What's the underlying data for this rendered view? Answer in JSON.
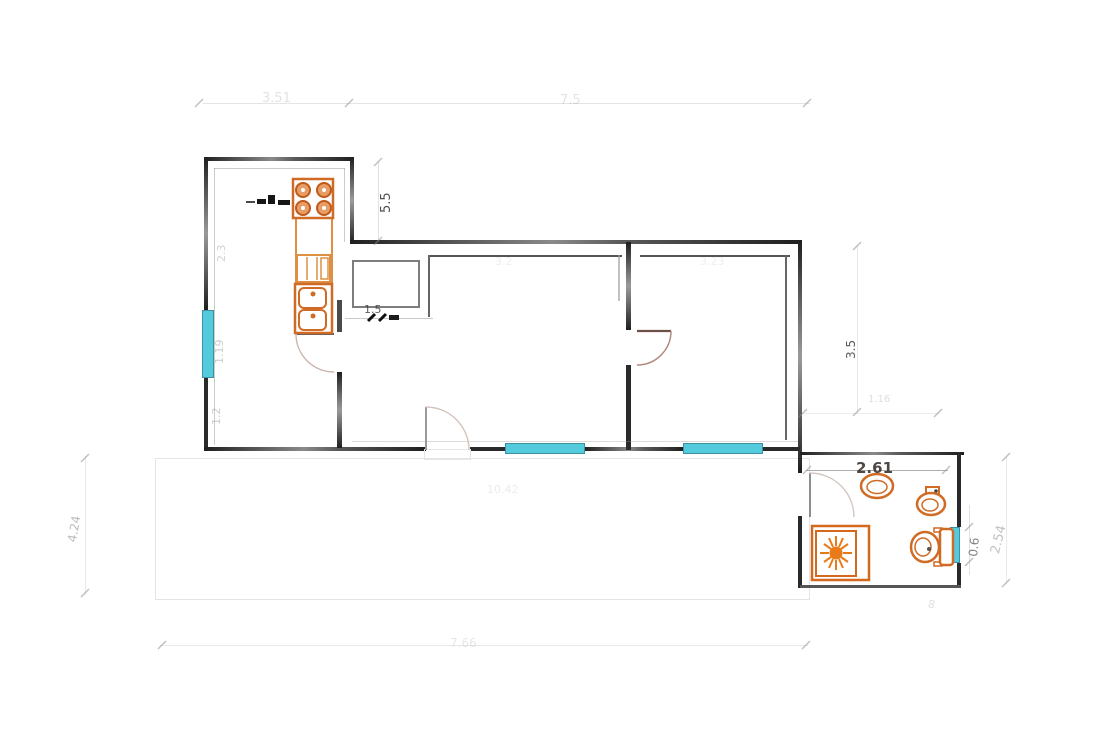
{
  "document": {
    "type": "architectural-floor-plan",
    "description": "Faded scan of an apartment floor plan: kitchen with stove and sink on the left, hallway with closet, two rooms with windows, bathroom with shower, washbasin, bidet and toilet on the lower right, terrace outline below"
  },
  "colors": {
    "background": "#ffffff",
    "wall": "#2a2a2a",
    "fixture_orange": "#cf6b25",
    "fixture_orange_light": "#e8954e",
    "window_cyan": "#53cbdc",
    "door_arc": "#c2988a",
    "dim_text_dark": "#3a3a3a",
    "dim_text_faint": "#b5b5b5"
  },
  "labels": {
    "dim_top_left": "3.51",
    "dim_top_right": "7.5",
    "dim_kitchen_step": "5.5",
    "dim_kitchen_upper": "2.3",
    "dim_kitchen_window": "1.19",
    "dim_kitchen_lower": "1.2",
    "dim_hallway": "1.5",
    "dim_right_wall": "3.5",
    "dim_above_bathroom": "1.16",
    "dim_bathroom_width": "2.61",
    "dim_bathroom_window": "0.6",
    "dim_bathroom_height": "2.54",
    "dim_terrace_left": "4.24",
    "dim_terrace_bottom": "7.66",
    "dim_room_1": "3.2",
    "dim_room_2": "3.23",
    "dim_terrace_inner": "10.42",
    "dim_bathroom_bottom": "8"
  },
  "fixtures": [
    {
      "name": "stove",
      "burners": 4
    },
    {
      "name": "kitchen-cabinet"
    },
    {
      "name": "kitchen-sink",
      "basins": 2
    },
    {
      "name": "hall-closet"
    },
    {
      "name": "shower"
    },
    {
      "name": "washbasin"
    },
    {
      "name": "bidet"
    },
    {
      "name": "toilet"
    }
  ],
  "openings": {
    "windows": 4,
    "doors": 4
  }
}
